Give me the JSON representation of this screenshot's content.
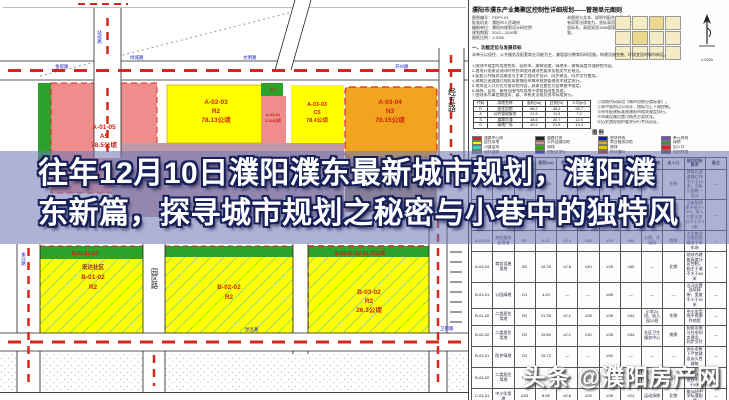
{
  "banner": {
    "line1": "往年12月10日濮阳濮东最新城市规划，濮阳濮",
    "line2": "东新篇，探寻城市规划之秘密与小巷中的独特风"
  },
  "watermark": {
    "brand": "头条",
    "handle": "@濮阳房产网"
  },
  "map": {
    "blocks": {
      "p1": {
        "code": "A-01-05",
        "use": "A5",
        "area": "78.5公顷"
      },
      "y1": {
        "code": "A-02-03",
        "use": "R2",
        "area": "78.13公顷"
      },
      "p2": {
        "code": "A-03-01",
        "area": "1.32公顷"
      },
      "gsq": {
        "code": "G1"
      },
      "y2": {
        "code": "A-03-03",
        "use": "C5",
        "area": "78.4公顷"
      },
      "o1": {
        "code": "A-03-04",
        "use": "N3",
        "area": "78.15公顷"
      },
      "b1": {
        "name": "宏达社区",
        "code": "B-01-02",
        "use": "R2"
      },
      "b2": {
        "code": "B-02-02",
        "use": "R2"
      },
      "b3": {
        "code": "B-03-02",
        "use": "R2",
        "area": "26.3公顷"
      },
      "b1strip": {
        "text": "B-01-01  G2"
      },
      "b3strip": {
        "text": "B-03-01  G2  15.72公顷"
      }
    },
    "road_labels": [
      "金堤路",
      "绿城路",
      "文明路",
      "开州路",
      "站前路",
      "振兴路",
      "昆吾路",
      "卫都路",
      "龙山街"
    ],
    "vroad1": "经五路",
    "vroad2": "园区路"
  },
  "panel": {
    "title": "濮阳市濮东产业集聚区控制性详细规划——管理单元图则",
    "block_a": "图则编号：PDPY-03\n批准机关：濮阳市人民政府\n编制单位：濮阳市规划设计研究院\n规划期限：2012—2030年\n图纸比例：1:2000",
    "block_b": "本图则与文本、说明书配合使用，具有同等法律效力。坐标采用1980西安坐标系，高程采用1985国家高程基准。",
    "bold_line": "一、功能定位与发展目标",
    "p3": "本单元以居住、公共服务及配套商业功能为主，兼容部分教育科研设施，构建设施完善、环境宜居的城市新区。",
    "notes": [
      "1.图则中规定的用地性质、容积率、建筑密度、绿地率、建筑高度为强制性内容。",
      "2.地块开发建设须同时符合本图则通则性要求及相关专业规范。",
      "3.配套公共服务设施须与主体工程同步设计、同步建设、同步交付使用。",
      "4.建筑后退道路红线距离按濮阳市城市规划管理技术规定执行。",
      "5.地块出入口方位为指导性内容，具体位置在方案审查中核定。",
      "6.绿线、蓝线、黄线范围内的用地不得擅自改变用途。",
      "7.图则未尽事宜按国家、省、市有关法规及技术标准执行。"
    ],
    "notes2": [
      "①用地代码采用《城市用地分类标准》。",
      "②表中面积以公顷计，指标为上下限控制。",
      "③停车配建标准按濮阳市相关规定执行。",
      "④市政设施位置可结合方案优化。",
      "⑤历史遗存保护要求另行专项论证。"
    ],
    "mini_table": {
      "headers": [
        "代码",
        "用地名称",
        "面积(ha)",
        "比例(%)",
        "人均(㎡)"
      ],
      "rows": [
        [
          "R",
          "居住用地",
          "86.2",
          "46.2",
          "28.7"
        ],
        [
          "A",
          "公共管理服务",
          "21.5",
          "11.5",
          "7.2"
        ],
        [
          "S",
          "道路交通",
          "38.6",
          "20.7",
          "12.9"
        ],
        [
          "G",
          "绿地广场",
          "40.2",
          "21.6",
          "13.4"
        ]
      ]
    },
    "legend_title": "图  例",
    "legend_items": [
      {
        "swatch": "#d4281c",
        "label": "道路中心线"
      },
      {
        "swatch": "#222222",
        "label": "道路红线"
      },
      {
        "swatch": "#1818c0",
        "label": "地块界线"
      },
      {
        "swatch": "#7a4fb5",
        "label": "单元界线"
      },
      {
        "swatch": "#ffff00",
        "label": "居住用地"
      },
      {
        "swatch": "#ef8d8d",
        "label": "公共设施用地"
      },
      {
        "swatch": "#f2a41f",
        "label": "商业服务用地"
      },
      {
        "swatch": "#2ba32b",
        "label": "绿地"
      },
      {
        "swatch": "#49c8c8",
        "label": "河道蓝线"
      },
      {
        "swatch": "#2ba32b",
        "label": "绿线"
      },
      {
        "swatch": "#e8c400",
        "label": "黄线"
      },
      {
        "swatch": "#d4281c",
        "label": "出入口"
      },
      {
        "swatch": "#888888",
        "label": "现状道路"
      },
      {
        "swatch": "#1818c0",
        "label": "控制点坐标"
      },
      {
        "swatch": "#cc1f10",
        "label": "地块编码"
      },
      {
        "swatch": "#555555",
        "label": "规划铁路"
      }
    ],
    "scale": "1:2000",
    "big_table": {
      "headers": [
        "地块编码",
        "用地性质",
        "代码",
        "面积(ha)",
        "容积率",
        "密度(%)",
        "绿地率(%)",
        "高度(m)",
        "配套设施",
        "出入口",
        "规划控制要求",
        "备注"
      ],
      "rows": [
        [
          "A-01-05",
          "行政办公用地",
          "A1",
          "12.65",
          "≤1.5",
          "≤30",
          "≥35",
          "≤36",
          "—",
          "东侧",
          "建筑后退道路红线不小于10米，沿街立面统一设计",
          "—"
        ],
        [
          "A-02-03",
          "二类居住用地",
          "R2",
          "18.13",
          "≤2.4",
          "≤28",
          "≥35",
          "≤54",
          "幼儿园9班、社区服务站",
          "南侧",
          "沿街贴线率不低于70%，出入口距交叉口不小于50米",
          "—"
        ],
        [
          "A-03-03",
          "商业服务业用地",
          "B1",
          "6.42",
          "≤3.0",
          "≤45",
          "≥20",
          "≤60",
          "公厕、开闭所",
          "西侧",
          "大型商业设施应配建地下停车场",
          "—"
        ],
        [
          "A-03-04",
          "商务设施用地",
          "B2",
          "15.78",
          "≤2.8",
          "≤40",
          "≥25",
          "≤80",
          "—",
          "北侧",
          "地块内建筑高度分区控制，临主干道不大于80米",
          "—"
        ],
        [
          "B-01-01",
          "公园绿地",
          "G1",
          "4.20",
          "—",
          "—",
          "≥85",
          "—",
          "—",
          "—",
          "沿河设置连续绿带，宽度不小于30米",
          "—"
        ],
        [
          "B-01-02",
          "二类居住用地",
          "R2",
          "21.35",
          "≤2.2",
          "≤28",
          "≥35",
          "≤54",
          "小学24班、幼儿园12班",
          "东侧",
          "中小学用地不得挪作他用",
          "—"
        ],
        [
          "B-02-02",
          "二类居住用地",
          "R2",
          "19.80",
          "≤2.2",
          "≤30",
          "≥35",
          "≤54",
          "社区卫生服务中心",
          "南侧",
          "配套设施与住宅同步建设、同步交付",
          "—"
        ],
        [
          "B-03-01",
          "防护绿地",
          "G2",
          "15.72",
          "—",
          "—",
          "≥90",
          "—",
          "—",
          "—",
          "高压走廊下严禁建设永久性建筑",
          "—"
        ],
        [
          "B-03-02",
          "二类居住用地",
          "R2",
          "26.30",
          "≤2.4",
          "≤28",
          "≥35",
          "≤60",
          "幼儿园9班、文化活动站",
          "西侧",
          "临规划路一侧建筑退线不小于8米",
          "—"
        ],
        [
          "C-01-01",
          "中小学用地",
          "A33",
          "8.96",
          "≤0.8",
          "≤25",
          "≥35",
          "≤24",
          "运动场地",
          "北侧",
          "按36班中学标准配建",
          "—"
        ],
        [
          "C-01-02",
          "医疗卫生用地",
          "A5",
          "6.08",
          "≤1.8",
          "≤30",
          "≥35",
          "≤50",
          "停车场",
          "东侧",
          "预留远期发展用地",
          "—"
        ]
      ]
    }
  }
}
